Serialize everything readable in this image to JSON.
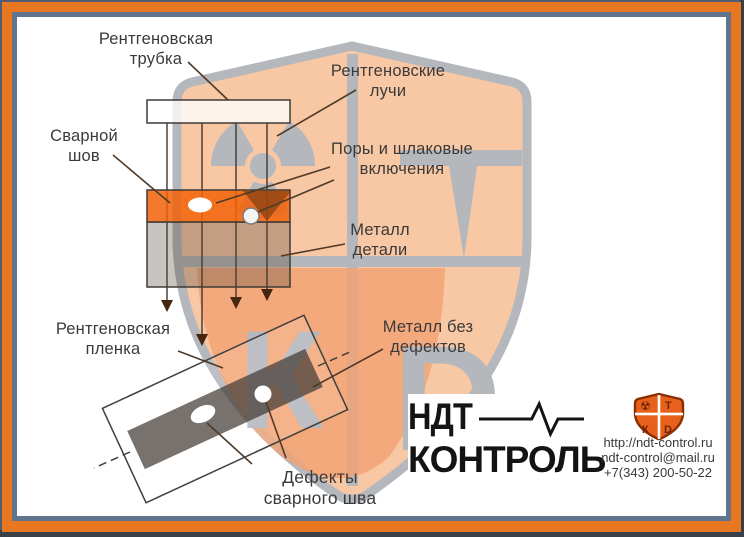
{
  "labels": {
    "tube": [
      "Рентгеновская",
      "трубка"
    ],
    "rays": [
      "Рентгеновские",
      "лучи"
    ],
    "seam": [
      "Сварной",
      "шов"
    ],
    "pores": [
      "Поры и шлаковые",
      "включения"
    ],
    "metal": [
      "Металл",
      "детали"
    ],
    "film": [
      "Рентгеновская",
      "пленка"
    ],
    "clean": [
      "Металл без",
      "дефектов"
    ],
    "defects": [
      "Дефекты",
      "сварного шва"
    ]
  },
  "logo": {
    "line1": "НДТ",
    "line2": "КОНТРОЛЬ"
  },
  "contact": {
    "website": "http://ndt-control.ru",
    "email": "ndt-control@mail.ru",
    "phone": "+7(343) 200-50-22"
  },
  "watermark": {
    "glyphs": [
      "Т",
      "К",
      "D"
    ]
  },
  "icon": {
    "glyphs": [
      "☢",
      "Т",
      "К",
      "D"
    ]
  },
  "colors": {
    "frame_orange": "#e87722",
    "frame_slate": "#60748e",
    "weld_orange": "#f2620a",
    "shield_peach": "#f8c7a4",
    "shield_gray": "#b4b7bc",
    "text_gray": "#3a3a3a"
  }
}
